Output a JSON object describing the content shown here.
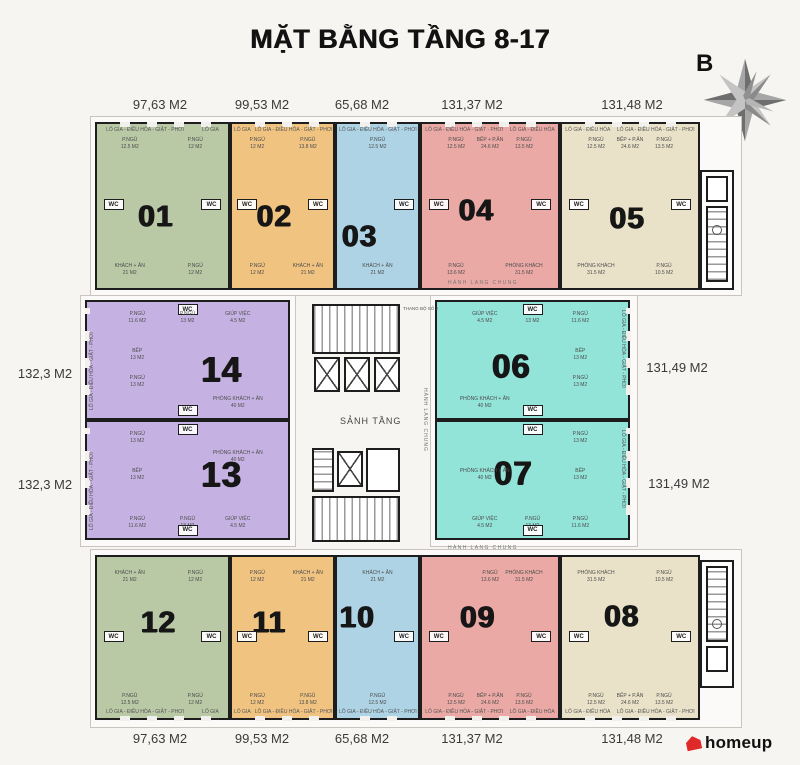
{
  "title": "MẶT BẰNG TẦNG 8-17",
  "compass": {
    "label": "B"
  },
  "logo": {
    "text": "homeup",
    "accent_color": "#e02a2a"
  },
  "wall_color": "#1d1d1d",
  "area_labels": {
    "top": [
      "97,63 M2",
      "99,53 M2",
      "65,68 M2",
      "131,37 M2",
      "131,48 M2"
    ],
    "bottom": [
      "97,63 M2",
      "99,53 M2",
      "65,68 M2",
      "131,37 M2",
      "131,48 M2"
    ],
    "left": [
      "132,3 M2",
      "132,3 M2"
    ],
    "right": [
      "131,49 M2",
      "131,49 M2"
    ]
  },
  "corridor_labels": {
    "top": "HÀNH LANG CHUNG",
    "bottom": "HÀNH LANG CHUNG",
    "middle": "HÀNH LANG CHUNG"
  },
  "core": {
    "lobby": "SẢNH TẦNG",
    "stair_note": "THANG BỘ SỐ 2"
  },
  "units": [
    {
      "number": "01",
      "color": "#b9c8a5",
      "area": "97,63 M2",
      "edge_labels": [
        "LÔ GIA - ĐIỀU HÒA - GIẶT - PHƠI",
        "LÔ GIA"
      ],
      "rooms": [
        {
          "slot": "tl",
          "name": "P.NGỦ",
          "area": "12.5 M2"
        },
        {
          "slot": "tr",
          "name": "P.NGỦ",
          "area": "12 M2"
        },
        {
          "slot": "wcl",
          "name": "WC",
          "wc": true
        },
        {
          "slot": "wcr",
          "name": "WC",
          "wc": true
        },
        {
          "slot": "bl",
          "name": "KHÁCH + ĂN",
          "area": "21 M2"
        },
        {
          "slot": "br",
          "name": "P.NGỦ",
          "area": "12 M2"
        }
      ]
    },
    {
      "number": "02",
      "color": "#f0c381",
      "area": "99,53 M2",
      "edge_labels": [
        "LÔ GIA",
        "LÔ GIA - ĐIỀU HÒA - GIẶT - PHƠI"
      ],
      "rooms": [
        {
          "slot": "tl",
          "name": "P.NGỦ",
          "area": "12 M2"
        },
        {
          "slot": "tr",
          "name": "P.NGỦ",
          "area": "13.8 M2"
        },
        {
          "slot": "wcl",
          "name": "WC",
          "wc": true
        },
        {
          "slot": "wcr",
          "name": "WC",
          "wc": true
        },
        {
          "slot": "bl",
          "name": "P.NGỦ",
          "area": "12 M2"
        },
        {
          "slot": "br",
          "name": "KHÁCH + ĂN",
          "area": "21 M2"
        }
      ]
    },
    {
      "number": "03",
      "color": "#aed3e5",
      "area": "65,68 M2",
      "edge_labels": [
        "LÔ GIA - ĐIỀU HÒA - GIẶT - PHƠI"
      ],
      "rooms": [
        {
          "slot": "tm",
          "name": "P.NGỦ",
          "area": "12.5 M2"
        },
        {
          "slot": "wcr",
          "name": "WC",
          "wc": true
        },
        {
          "slot": "bm",
          "name": "KHÁCH + ĂN",
          "area": "21 M2"
        }
      ]
    },
    {
      "number": "04",
      "color": "#eaa9a5",
      "area": "131,37 M2",
      "edge_labels": [
        "LÔ GIA - ĐIỀU HÒA - GIẶT - PHƠI",
        "LÔ GIA - ĐIỀU HÒA"
      ],
      "rooms": [
        {
          "slot": "tl",
          "name": "P.NGỦ",
          "area": "12.5 M2"
        },
        {
          "slot": "tm",
          "name": "BẾP + P.ĂN",
          "area": "24.6 M2"
        },
        {
          "slot": "tr",
          "name": "P.NGỦ",
          "area": "13.5 M2"
        },
        {
          "slot": "wcl",
          "name": "WC",
          "wc": true
        },
        {
          "slot": "wcr",
          "name": "WC",
          "wc": true
        },
        {
          "slot": "bl",
          "name": "P.NGỦ",
          "area": "13.6 M2"
        },
        {
          "slot": "br",
          "name": "PHÒNG KHÁCH",
          "area": "31.5 M2"
        }
      ]
    },
    {
      "number": "05",
      "color": "#eae2c8",
      "area": "131,48 M2",
      "edge_labels": [
        "LÔ GIA - ĐIỀU HÒA",
        "LÔ GIA - ĐIỀU HÒA - GIẶT - PHƠI"
      ],
      "rooms": [
        {
          "slot": "tl",
          "name": "P.NGỦ",
          "area": "12.5 M2"
        },
        {
          "slot": "tm",
          "name": "BẾP + P.ĂN",
          "area": "24.6 M2"
        },
        {
          "slot": "tr",
          "name": "P.NGỦ",
          "area": "13.5 M2"
        },
        {
          "slot": "wcl",
          "name": "WC",
          "wc": true
        },
        {
          "slot": "wcr",
          "name": "WC",
          "wc": true
        },
        {
          "slot": "bl",
          "name": "PHÒNG KHÁCH",
          "area": "31.5 M2"
        },
        {
          "slot": "br",
          "name": "P.NGỦ",
          "area": "10.5 M2"
        }
      ]
    },
    {
      "number": "06",
      "color": "#92e3d8",
      "area": "131,49 M2",
      "edge_labels": [
        "LÔ GIA - ĐIỀU HÒA - GIẶT - PHƠI"
      ],
      "rooms": [
        {
          "slot": "tl",
          "name": "GIÚP VIỆC",
          "area": "4.5 M2"
        },
        {
          "slot": "tm",
          "name": "P.NGỦ",
          "area": "13 M2"
        },
        {
          "slot": "wct",
          "name": "WC",
          "wc": true
        },
        {
          "slot": "tr",
          "name": "P.NGỦ",
          "area": "11.6 M2"
        },
        {
          "slot": "mr",
          "name": "BẾP",
          "area": "13 M2"
        },
        {
          "slot": "mr2",
          "name": "P.NGỦ",
          "area": "13 M2"
        },
        {
          "slot": "bl",
          "name": "PHÒNG KHÁCH + ĂN",
          "area": "40 M2"
        },
        {
          "slot": "wcb",
          "name": "WC",
          "wc": true
        }
      ]
    },
    {
      "number": "07",
      "color": "#92e3d8",
      "area": "131,49 M2",
      "edge_labels": [
        "LÔ GIA - ĐIỀU HÒA - GIẶT - PHƠI"
      ],
      "rooms": [
        {
          "slot": "wct",
          "name": "WC",
          "wc": true
        },
        {
          "slot": "ml",
          "name": "PHÒNG KHÁCH + ĂN",
          "area": "40 M2"
        },
        {
          "slot": "tr",
          "name": "P.NGỦ",
          "area": "13 M2"
        },
        {
          "slot": "mr",
          "name": "BẾP",
          "area": "13 M2"
        },
        {
          "slot": "bl",
          "name": "GIÚP VIỆC",
          "area": "4.5 M2"
        },
        {
          "slot": "bm",
          "name": "P.NGỦ",
          "area": "13 M2"
        },
        {
          "slot": "br",
          "name": "P.NGỦ",
          "area": "11.6 M2"
        },
        {
          "slot": "wcb",
          "name": "WC",
          "wc": true
        }
      ]
    },
    {
      "number": "08",
      "color": "#eae2c8",
      "area": "131,48 M2",
      "edge_labels": [
        "LÔ GIA - ĐIỀU HÒA",
        "LÔ GIA - ĐIỀU HÒA - GIẶT - PHƠI"
      ],
      "rooms": [
        {
          "slot": "tl",
          "name": "PHÒNG KHÁCH",
          "area": "31.5 M2"
        },
        {
          "slot": "tr",
          "name": "P.NGỦ",
          "area": "10.5 M2"
        },
        {
          "slot": "wcl",
          "name": "WC",
          "wc": true
        },
        {
          "slot": "wcr",
          "name": "WC",
          "wc": true
        },
        {
          "slot": "bl",
          "name": "P.NGỦ",
          "area": "12.5 M2"
        },
        {
          "slot": "bm",
          "name": "BẾP + P.ĂN",
          "area": "24.6 M2"
        },
        {
          "slot": "br",
          "name": "P.NGỦ",
          "area": "13.5 M2"
        }
      ]
    },
    {
      "number": "09",
      "color": "#eaa9a5",
      "area": "131,37 M2",
      "edge_labels": [
        "LÔ GIA - ĐIỀU HÒA - GIẶT - PHƠI",
        "LÔ GIA - ĐIỀU HÒA"
      ],
      "rooms": [
        {
          "slot": "tm",
          "name": "P.NGỦ",
          "area": "13.6 M2"
        },
        {
          "slot": "tr",
          "name": "PHÒNG KHÁCH",
          "area": "31.5 M2"
        },
        {
          "slot": "wcl",
          "name": "WC",
          "wc": true
        },
        {
          "slot": "wcr",
          "name": "WC",
          "wc": true
        },
        {
          "slot": "bl",
          "name": "P.NGỦ",
          "area": "12.5 M2"
        },
        {
          "slot": "bm",
          "name": "BẾP + P.ĂN",
          "area": "24.6 M2"
        },
        {
          "slot": "br",
          "name": "P.NGỦ",
          "area": "13.5 M2"
        }
      ]
    },
    {
      "number": "10",
      "color": "#aed3e5",
      "area": "65,68 M2",
      "edge_labels": [
        "LÔ GIA - ĐIỀU HÒA - GIẶT - PHƠI"
      ],
      "rooms": [
        {
          "slot": "tm",
          "name": "KHÁCH + ĂN",
          "area": "21 M2"
        },
        {
          "slot": "wcr",
          "name": "WC",
          "wc": true
        },
        {
          "slot": "bm",
          "name": "P.NGỦ",
          "area": "12.5 M2"
        }
      ]
    },
    {
      "number": "11",
      "color": "#f0c381",
      "area": "99,53 M2",
      "edge_labels": [
        "LÔ GIA",
        "LÔ GIA - ĐIỀU HÒA - GIẶT - PHƠI"
      ],
      "rooms": [
        {
          "slot": "tl",
          "name": "P.NGỦ",
          "area": "12 M2"
        },
        {
          "slot": "tr",
          "name": "KHÁCH + ĂN",
          "area": "21 M2"
        },
        {
          "slot": "wcl",
          "name": "WC",
          "wc": true
        },
        {
          "slot": "wcr",
          "name": "WC",
          "wc": true
        },
        {
          "slot": "bl",
          "name": "P.NGỦ",
          "area": "12 M2"
        },
        {
          "slot": "br",
          "name": "P.NGỦ",
          "area": "13.8 M2"
        }
      ]
    },
    {
      "number": "12",
      "color": "#b9c8a5",
      "area": "97,63 M2",
      "edge_labels": [
        "LÔ GIA - ĐIỀU HÒA - GIẶT - PHƠI",
        "LÔ GIA"
      ],
      "rooms": [
        {
          "slot": "tl",
          "name": "KHÁCH + ĂN",
          "area": "21 M2"
        },
        {
          "slot": "tr",
          "name": "P.NGỦ",
          "area": "12 M2"
        },
        {
          "slot": "wcl",
          "name": "WC",
          "wc": true
        },
        {
          "slot": "wcr",
          "name": "WC",
          "wc": true
        },
        {
          "slot": "bl",
          "name": "P.NGỦ",
          "area": "12.5 M2"
        },
        {
          "slot": "br",
          "name": "P.NGỦ",
          "area": "12 M2"
        }
      ]
    },
    {
      "number": "13",
      "color": "#c6b2e2",
      "area": "132,3 M2",
      "edge_labels": [
        "LÔ GIA - ĐIỀU HÒA - GIẶT - PHƠI"
      ],
      "rooms": [
        {
          "slot": "wct",
          "name": "WC",
          "wc": true
        },
        {
          "slot": "tl",
          "name": "P.NGỦ",
          "area": "13 M2"
        },
        {
          "slot": "mru",
          "name": "PHÒNG KHÁCH + ĂN",
          "area": "40 M2"
        },
        {
          "slot": "ml",
          "name": "BẾP",
          "area": "13 M2"
        },
        {
          "slot": "bl",
          "name": "P.NGỦ",
          "area": "11.6 M2"
        },
        {
          "slot": "bm",
          "name": "P.NGỦ",
          "area": "13 M2"
        },
        {
          "slot": "br",
          "name": "GIÚP VIỆC",
          "area": "4.5 M2"
        },
        {
          "slot": "wcb",
          "name": "WC",
          "wc": true
        }
      ]
    },
    {
      "number": "14",
      "color": "#c6b2e2",
      "area": "132,3 M2",
      "edge_labels": [
        "LÔ GIA - ĐIỀU HÒA - GIẶT - PHƠI"
      ],
      "rooms": [
        {
          "slot": "wct",
          "name": "WC",
          "wc": true
        },
        {
          "slot": "tl",
          "name": "P.NGỦ",
          "area": "11.6 M2"
        },
        {
          "slot": "tm",
          "name": "P.NGỦ",
          "area": "13 M2"
        },
        {
          "slot": "tr",
          "name": "GIÚP VIỆC",
          "area": "4.5 M2"
        },
        {
          "slot": "ml",
          "name": "BẾP",
          "area": "13 M2"
        },
        {
          "slot": "ml2",
          "name": "P.NGỦ",
          "area": "13 M2"
        },
        {
          "slot": "br",
          "name": "PHÒNG KHÁCH + ĂN",
          "area": "40 M2"
        },
        {
          "slot": "wcb",
          "name": "WC",
          "wc": true
        }
      ]
    }
  ]
}
